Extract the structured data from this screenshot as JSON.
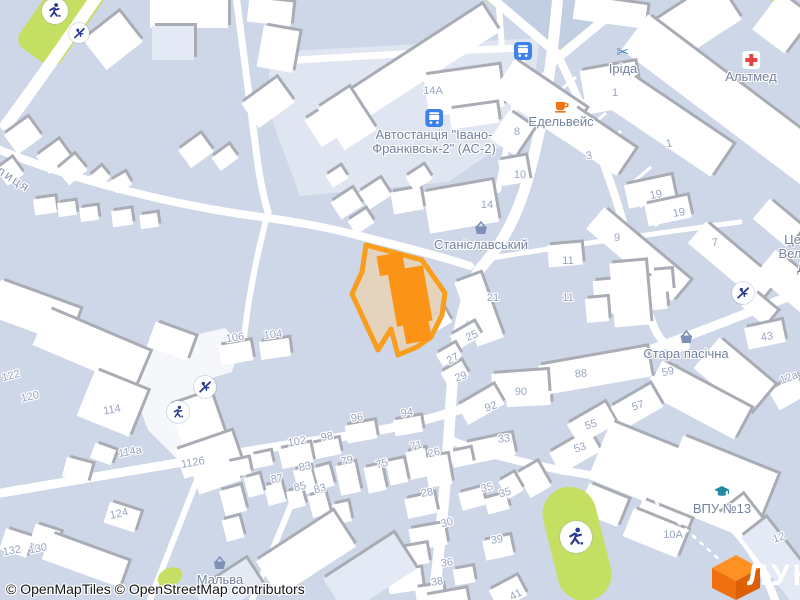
{
  "map": {
    "attribution": "© OpenMapTiles © OpenStreetMap contributors",
    "logo_text": "ЛУН",
    "street_labels": [
      {
        "text": "вулиця",
        "x": -16,
        "y": 152,
        "rot": 33
      }
    ],
    "poi_labels": [
      {
        "id": "bus-stop-north",
        "lines": [],
        "icon": "bus",
        "x": 523,
        "y": 42
      },
      {
        "id": "irida",
        "lines": [
          "Іріда"
        ],
        "icon": "scissors",
        "x": 623,
        "y": 43
      },
      {
        "id": "altmed",
        "lines": [
          "Альтмед"
        ],
        "icon": "medical-cross",
        "x": 751,
        "y": 51
      },
      {
        "id": "edelveis",
        "lines": [
          "Едельвейс"
        ],
        "icon": "coffee-cup",
        "x": 561,
        "y": 96
      },
      {
        "id": "bus-station",
        "lines": [
          "Автостанція \"Івано-",
          "Франківськ-2\" (АС-2)"
        ],
        "icon": "bus",
        "x": 434,
        "y": 109
      },
      {
        "id": "stanislavskyi",
        "lines": [
          "Станіславський"
        ],
        "icon": "shopping-basket",
        "x": 481,
        "y": 219
      },
      {
        "id": "stara-pasichna",
        "lines": [
          "Стара пасічна"
        ],
        "icon": "shopping-basket",
        "x": 686,
        "y": 328
      },
      {
        "id": "malva",
        "lines": [
          "Мальва"
        ],
        "icon": "shopping-basket",
        "x": 220,
        "y": 554
      },
      {
        "id": "vpu-13",
        "lines": [
          "ВПУ №13"
        ],
        "icon": "graduation-cap",
        "x": 722,
        "y": 483
      },
      {
        "id": "church",
        "lines": [
          "Церква",
          "Великого",
          "Дм"
        ],
        "icon": null,
        "x": 806,
        "y": 233
      }
    ],
    "house_numbers": [
      {
        "t": "14А",
        "x": 433,
        "y": 91
      },
      {
        "t": "8",
        "x": 517,
        "y": 132
      },
      {
        "t": "10",
        "x": 520,
        "y": 175
      },
      {
        "t": "1",
        "x": 615,
        "y": 93
      },
      {
        "t": "3",
        "x": 589,
        "y": 156,
        "r": -10
      },
      {
        "t": "1",
        "x": 669,
        "y": 144,
        "r": -10
      },
      {
        "t": "14",
        "x": 487,
        "y": 205
      },
      {
        "t": "19",
        "x": 656,
        "y": 195,
        "r": -10
      },
      {
        "t": "19",
        "x": 679,
        "y": 213,
        "r": -10
      },
      {
        "t": "9",
        "x": 617,
        "y": 238
      },
      {
        "t": "7",
        "x": 715,
        "y": 243,
        "r": -5
      },
      {
        "t": "11",
        "x": 568,
        "y": 261
      },
      {
        "t": "11",
        "x": 568,
        "y": 298
      },
      {
        "t": "21",
        "x": 493,
        "y": 298
      },
      {
        "t": "25",
        "x": 472,
        "y": 336,
        "r": -24
      },
      {
        "t": "27",
        "x": 453,
        "y": 359,
        "r": -28
      },
      {
        "t": "29",
        "x": 461,
        "y": 377,
        "r": -20
      },
      {
        "t": "88",
        "x": 581,
        "y": 374,
        "r": -5
      },
      {
        "t": "90",
        "x": 521,
        "y": 392
      },
      {
        "t": "92",
        "x": 491,
        "y": 407,
        "r": -20
      },
      {
        "t": "59",
        "x": 668,
        "y": 372,
        "r": -12
      },
      {
        "t": "43",
        "x": 767,
        "y": 337,
        "r": -10
      },
      {
        "t": "12а",
        "x": 789,
        "y": 378,
        "r": -20
      },
      {
        "t": "55",
        "x": 591,
        "y": 425,
        "r": -18
      },
      {
        "t": "57",
        "x": 638,
        "y": 406,
        "r": -18
      },
      {
        "t": "53",
        "x": 580,
        "y": 448,
        "r": -18
      },
      {
        "t": "33",
        "x": 504,
        "y": 439,
        "r": -6
      },
      {
        "t": "35",
        "x": 487,
        "y": 488,
        "r": -12
      },
      {
        "t": "35",
        "x": 505,
        "y": 493,
        "r": -15
      },
      {
        "t": "39",
        "x": 497,
        "y": 540,
        "r": -10
      },
      {
        "t": "30",
        "x": 447,
        "y": 523,
        "r": -15
      },
      {
        "t": "26",
        "x": 434,
        "y": 453,
        "r": -14
      },
      {
        "t": "71",
        "x": 416,
        "y": 446,
        "r": -12
      },
      {
        "t": "75",
        "x": 382,
        "y": 464,
        "r": -15
      },
      {
        "t": "79",
        "x": 347,
        "y": 461,
        "r": -12
      },
      {
        "t": "98",
        "x": 327,
        "y": 437,
        "r": -10
      },
      {
        "t": "96",
        "x": 357,
        "y": 418,
        "r": -8
      },
      {
        "t": "94",
        "x": 407,
        "y": 413,
        "r": -8
      },
      {
        "t": "102",
        "x": 297,
        "y": 442,
        "r": -10
      },
      {
        "t": "83",
        "x": 305,
        "y": 467,
        "r": -12
      },
      {
        "t": "83",
        "x": 320,
        "y": 489,
        "r": -15
      },
      {
        "t": "85",
        "x": 300,
        "y": 487,
        "r": -12
      },
      {
        "t": "87",
        "x": 277,
        "y": 479,
        "r": -10
      },
      {
        "t": "28",
        "x": 427,
        "y": 493,
        "r": -10
      },
      {
        "t": "36",
        "x": 447,
        "y": 563,
        "r": -8
      },
      {
        "t": "38",
        "x": 437,
        "y": 582,
        "r": -8
      },
      {
        "t": "41",
        "x": 516,
        "y": 595,
        "r": -28
      },
      {
        "t": "106",
        "x": 235,
        "y": 338,
        "r": -8
      },
      {
        "t": "104",
        "x": 273,
        "y": 335,
        "r": -6
      },
      {
        "t": "122",
        "x": 11,
        "y": 376,
        "r": -15
      },
      {
        "t": "120",
        "x": 30,
        "y": 397,
        "r": -12
      },
      {
        "t": "114",
        "x": 112,
        "y": 410,
        "r": -10
      },
      {
        "t": "114а",
        "x": 130,
        "y": 452,
        "r": -10
      },
      {
        "t": "112б",
        "x": 193,
        "y": 463,
        "r": -10
      },
      {
        "t": "124",
        "x": 119,
        "y": 514,
        "r": -12
      },
      {
        "t": "132",
        "x": 12,
        "y": 551,
        "r": -10
      },
      {
        "t": "130",
        "x": 38,
        "y": 549,
        "r": -10
      },
      {
        "t": "10А",
        "x": 673,
        "y": 535
      },
      {
        "t": "12",
        "x": 779,
        "y": 538,
        "r": -20
      }
    ],
    "amenity_icons": [
      {
        "icon": "runner",
        "x": 55,
        "y": 11,
        "r": 13
      },
      {
        "icon": "slide",
        "x": 79,
        "y": 33,
        "r": 10
      },
      {
        "icon": "slide",
        "x": 205,
        "y": 387,
        "r": 11
      },
      {
        "icon": "runner",
        "x": 178,
        "y": 412,
        "r": 11
      },
      {
        "icon": "slide",
        "x": 743,
        "y": 293,
        "r": 11
      },
      {
        "icon": "runner",
        "x": 576,
        "y": 537,
        "r": 16
      }
    ],
    "colors": {
      "background": "#cdd7e8",
      "road": "#ffffff",
      "building": "#ffffff",
      "building_shadow": "#a9acb4",
      "water_area": "#c2cee2",
      "green_area": "#c5df63",
      "parcel_outline": "#f99d1c",
      "parcel_fill": "#e6d3b8",
      "parcel_building": "#fb9416",
      "poi_label": "#73839f",
      "house_number": "#98a5c1",
      "street_label": "#8a99b6",
      "logo_orange": "#f07010"
    }
  }
}
